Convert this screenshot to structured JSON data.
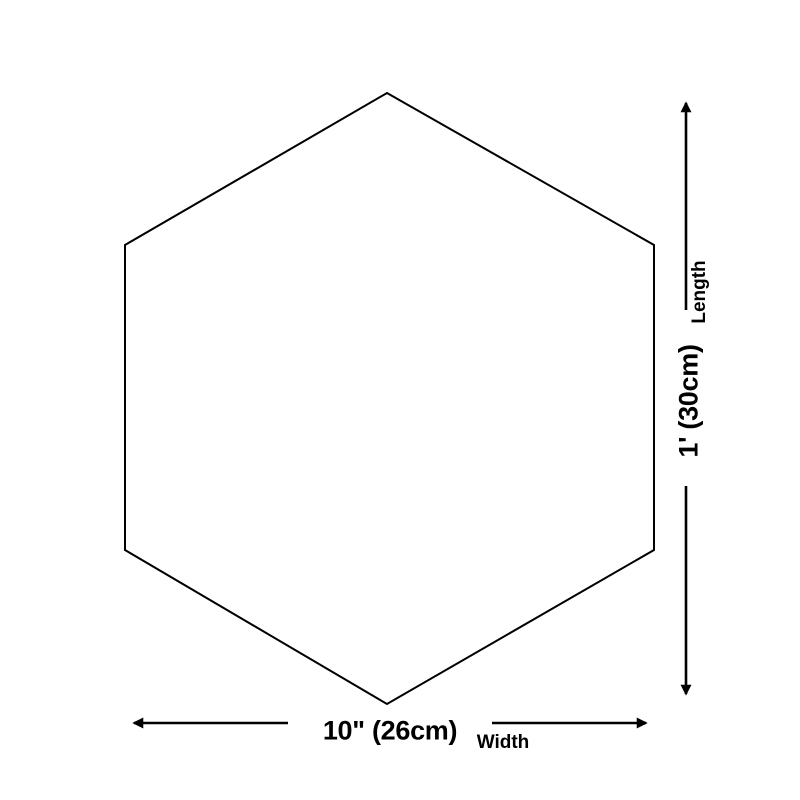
{
  "diagram": {
    "shape": "hexagon",
    "background_color": "#ffffff",
    "line_color": "#000000",
    "width_dimension": {
      "value": "10\" (26cm)",
      "label": "Width"
    },
    "length_dimension": {
      "value": "1' (30cm)",
      "label": "Length"
    }
  }
}
